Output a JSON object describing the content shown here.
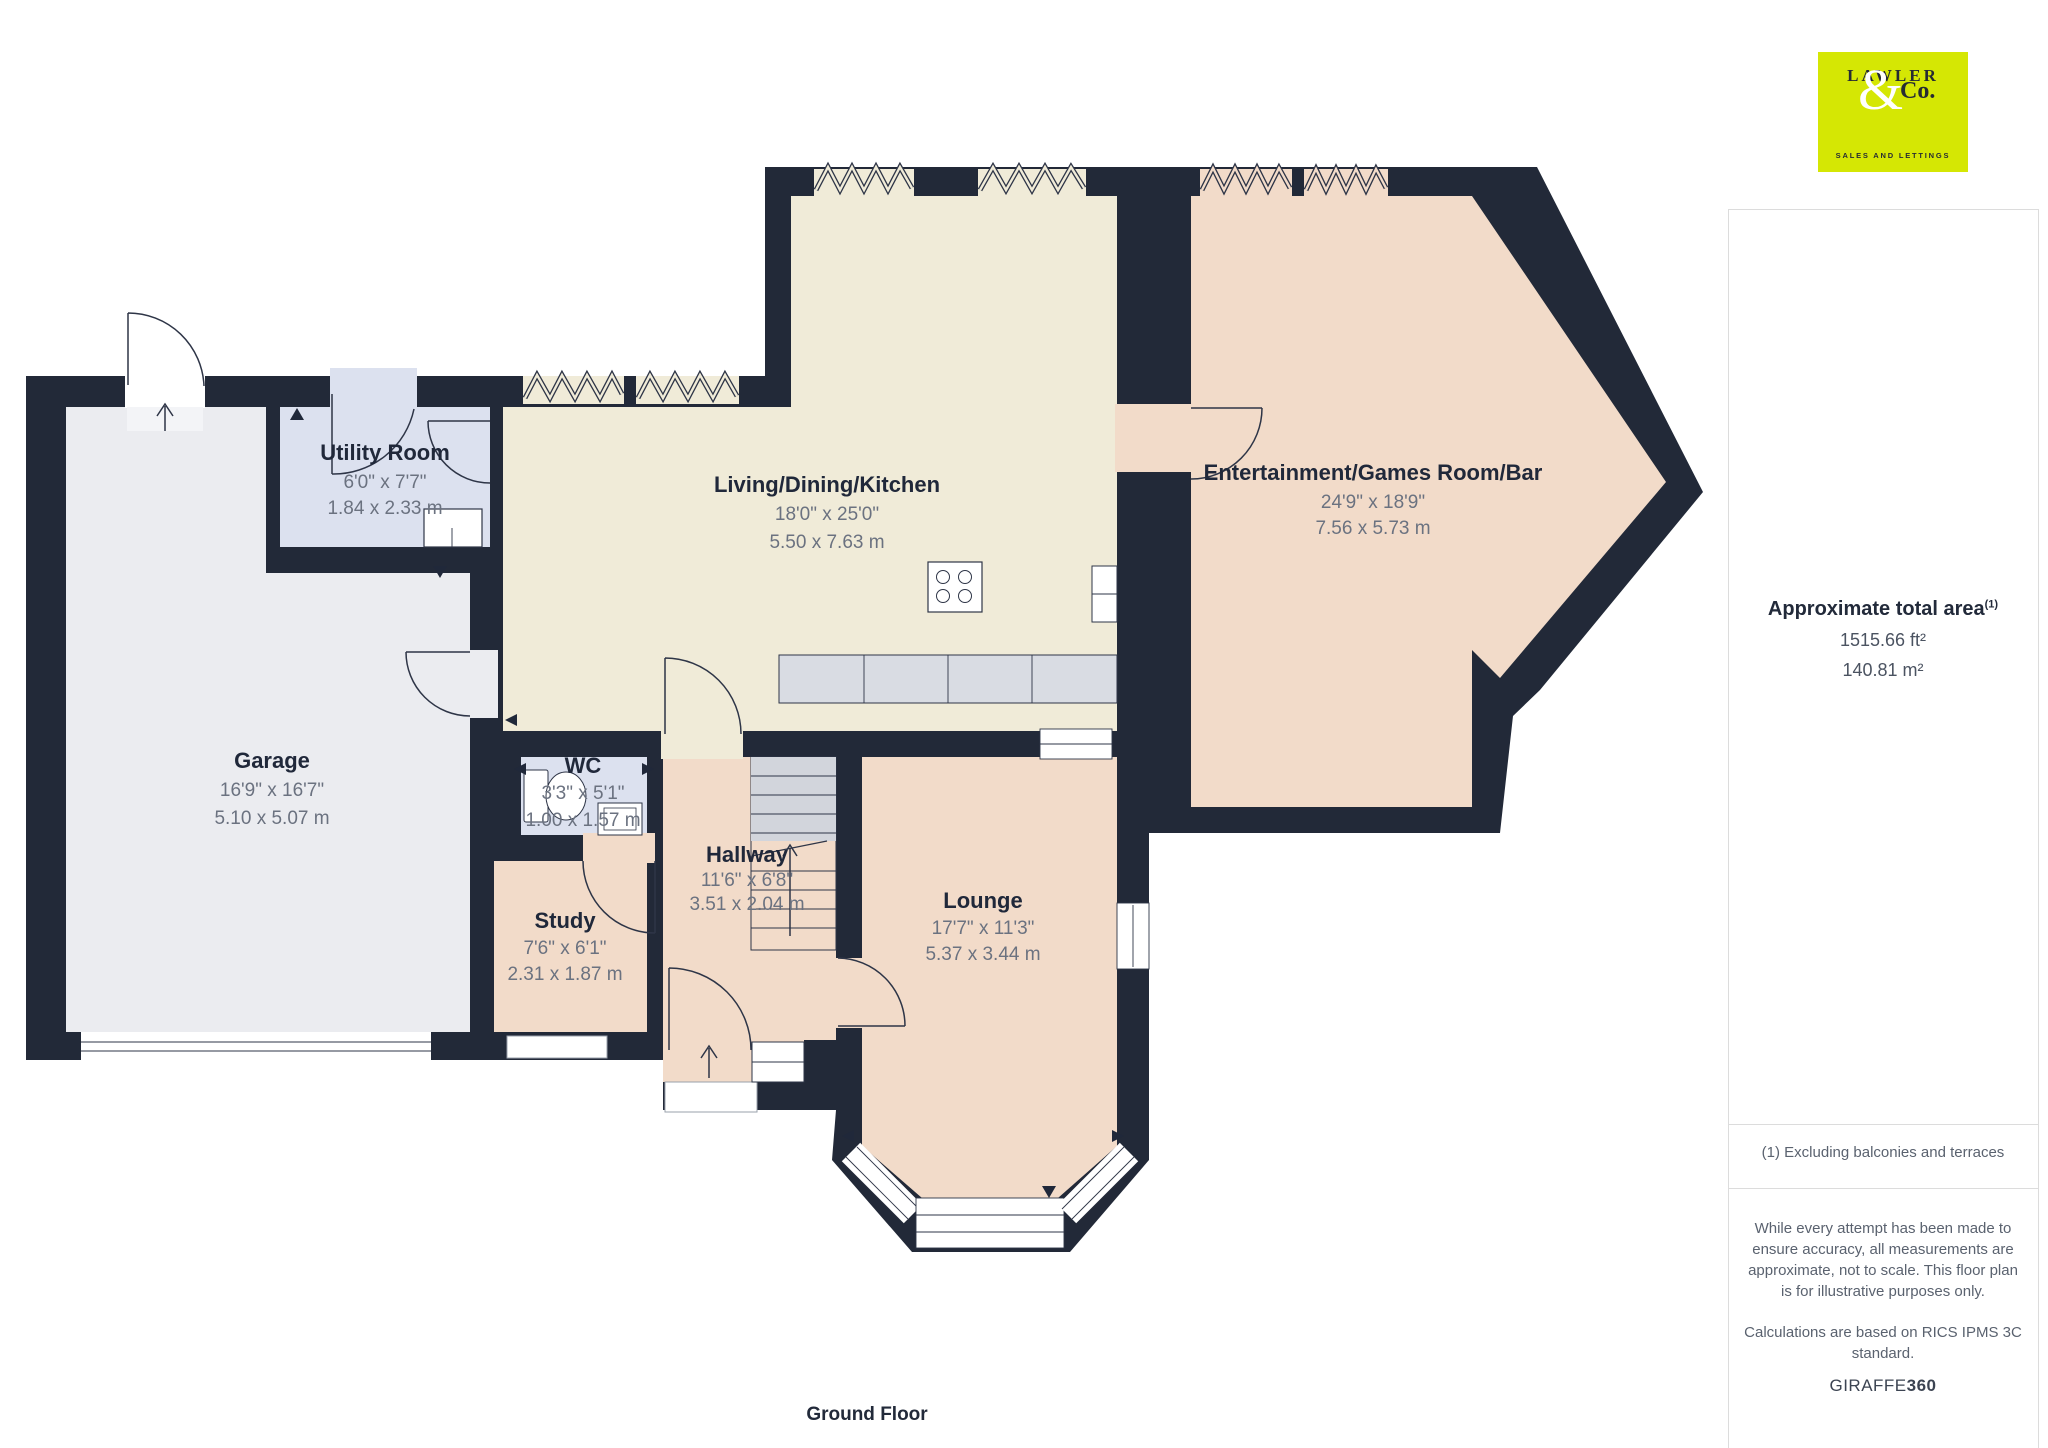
{
  "logo": {
    "name_top": "LAWLER",
    "ampersand": "&",
    "name_co": "Co.",
    "tagline": "SALES AND LETTINGS",
    "bg_color": "#d5e704"
  },
  "sidebar": {
    "area_title": "Approximate total area",
    "area_sup": "(1)",
    "area_ft": "1515.66 ft²",
    "area_m": "140.81 m²",
    "footnote": "(1) Excluding balconies and terraces",
    "disclaimer1": "While every attempt has been made to ensure accuracy, all measurements are approximate, not to scale. This floor plan is for illustrative purposes only.",
    "disclaimer2": "Calculations are based on RICS IPMS 3C standard.",
    "brand_regular": "GIRAFFE",
    "brand_bold": "360"
  },
  "plan": {
    "floor_label": "Ground Floor",
    "rooms": [
      {
        "name": "Utility Room",
        "dims_ft": "6'0\" x 7'7\"",
        "dims_m": "1.84 x 2.33 m"
      },
      {
        "name": "Living/Dining/Kitchen",
        "dims_ft": "18'0\" x 25'0\"",
        "dims_m": "5.50 x 7.63 m"
      },
      {
        "name": "Entertainment/Games Room/Bar",
        "dims_ft": "24'9\" x 18'9\"",
        "dims_m": "7.56 x 5.73 m"
      },
      {
        "name": "Garage",
        "dims_ft": "16'9\" x 16'7\"",
        "dims_m": "5.10 x 5.07 m"
      },
      {
        "name": "WC",
        "dims_ft": "3'3\" x 5'1\"",
        "dims_m": "1.00 x 1.57 m"
      },
      {
        "name": "Hallway",
        "dims_ft": "11'6\" x 6'8\"",
        "dims_m": "3.51 x 2.04 m"
      },
      {
        "name": "Study",
        "dims_ft": "7'6\" x 6'1\"",
        "dims_m": "2.31 x 1.87 m"
      },
      {
        "name": "Lounge",
        "dims_ft": "17'7\" x 11'3\"",
        "dims_m": "5.37 x 3.44 m"
      }
    ]
  },
  "colors": {
    "wall": "#222938",
    "kitchen_fill": "#f0ebd8",
    "pink_fill": "#f2dbc9",
    "blue_fill": "#dce1ef",
    "garage_fill": "#ebecf0",
    "counter_fill": "#d9dce3",
    "stairs_gray": "#d2d5dc",
    "logo_bg": "#d5e704",
    "label_dark": "#20283a",
    "dims_gray": "#6b7280"
  }
}
